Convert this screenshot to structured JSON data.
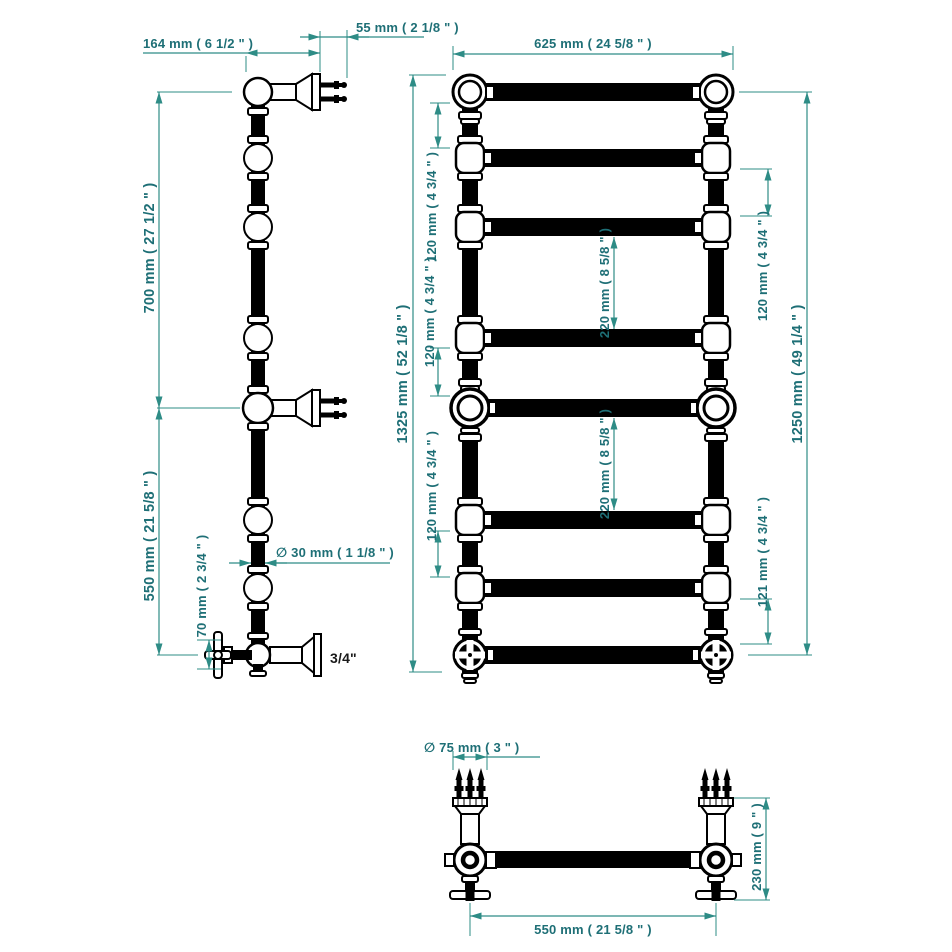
{
  "colors": {
    "dim_line": "#2E8C86",
    "dim_text": "#1E6F76",
    "drawing": "#000000",
    "label": "#1A1A1A",
    "background": "#FFFFFF"
  },
  "side_view": {
    "arm_length": "164 mm ( 6 1/2 \" )",
    "pin_depth": "55 mm ( 2 1/8 \" )",
    "upper_height": "700 mm ( 27 1/2 \" )",
    "lower_height": "550 mm ( 21 5/8 \" )",
    "valve_drop": "70 mm ( 2 3/4 \" )",
    "tube_diameter": "∅ 30 mm ( 1 1/8 \" )",
    "connection": "3/4\""
  },
  "front_view": {
    "width": "625 mm ( 24 5/8 \" )",
    "overall_height": "1325 mm ( 52 1/8 \" )",
    "rail_height": "1250 mm ( 49 1/4 \" )",
    "gap_120": "120 mm ( 4 3/4 \" )",
    "gap_121": "121 mm ( 4 3/4 \" )",
    "gap_220": "220 mm ( 8 5/8 \" )"
  },
  "bottom_view": {
    "flange_diameter": "∅ 75 mm ( 3 \" )",
    "depth": "230 mm ( 9 \" )",
    "centres": "550 mm ( 21 5/8 \" )"
  }
}
